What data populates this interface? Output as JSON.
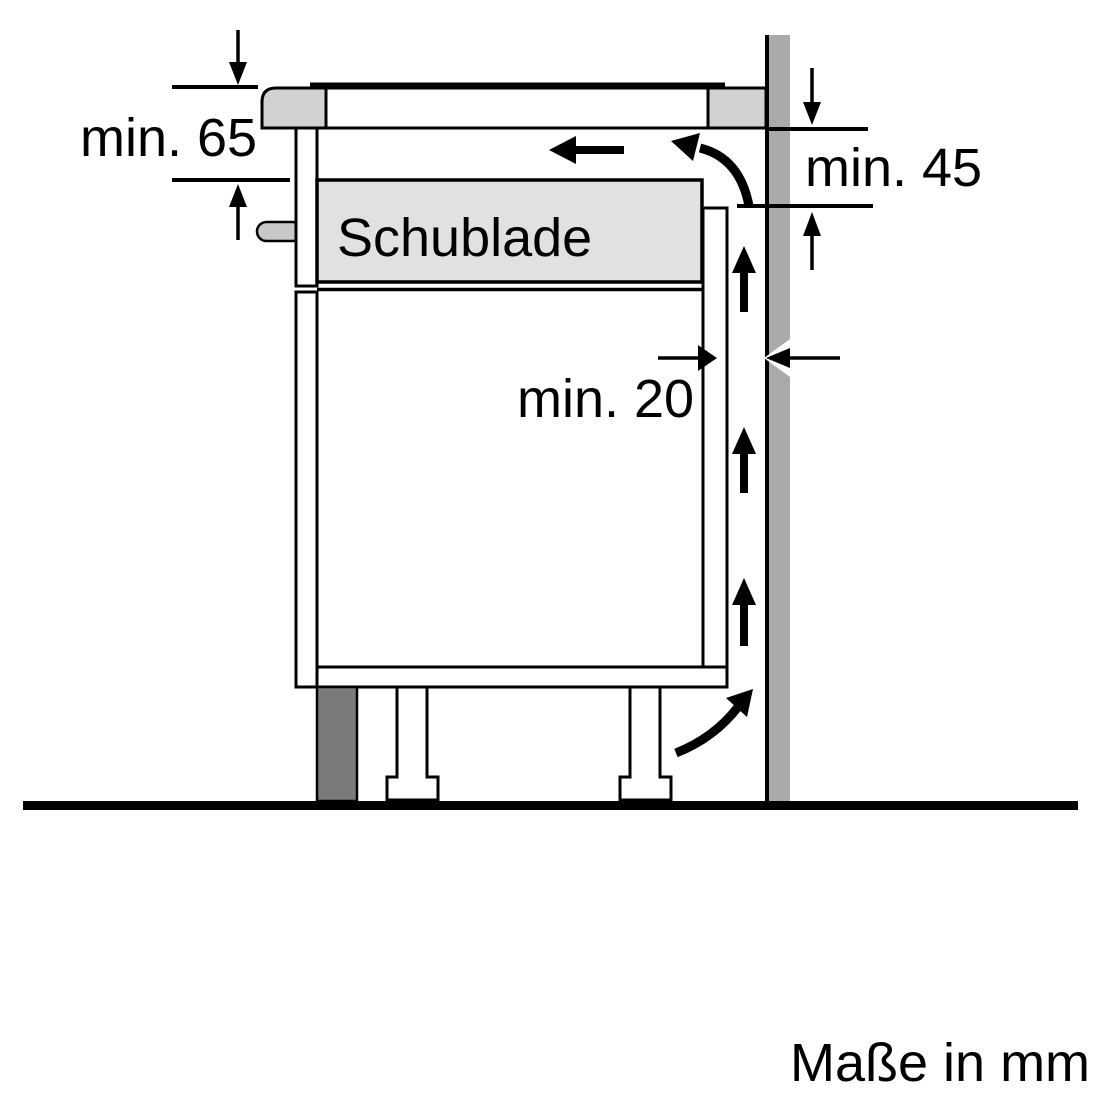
{
  "diagram": {
    "type": "appliance-installation-side-view",
    "unit_note": "Maße in mm",
    "labels": {
      "dim_hob_depth": "min. 65",
      "dim_rear_top_clearance": "min. 45",
      "dim_rear_gap": "min. 20",
      "drawer": "Schublade"
    },
    "colors": {
      "background": "#ffffff",
      "line": "#000000",
      "wall_gray": "#aaaaaa",
      "countertop_gray": "#d2d2d2",
      "drawer_gray": "#e1e1e1",
      "plinth_gray": "#7a7a7a",
      "tab_gray": "#c8c8c8"
    },
    "icons": {
      "airflow_up_arrows": 3,
      "airflow_left_arrow": 1,
      "airflow_curved_arrow_top": 1,
      "airflow_curved_arrow_bottom": 1,
      "dimension_arrow_pairs": 3
    }
  }
}
